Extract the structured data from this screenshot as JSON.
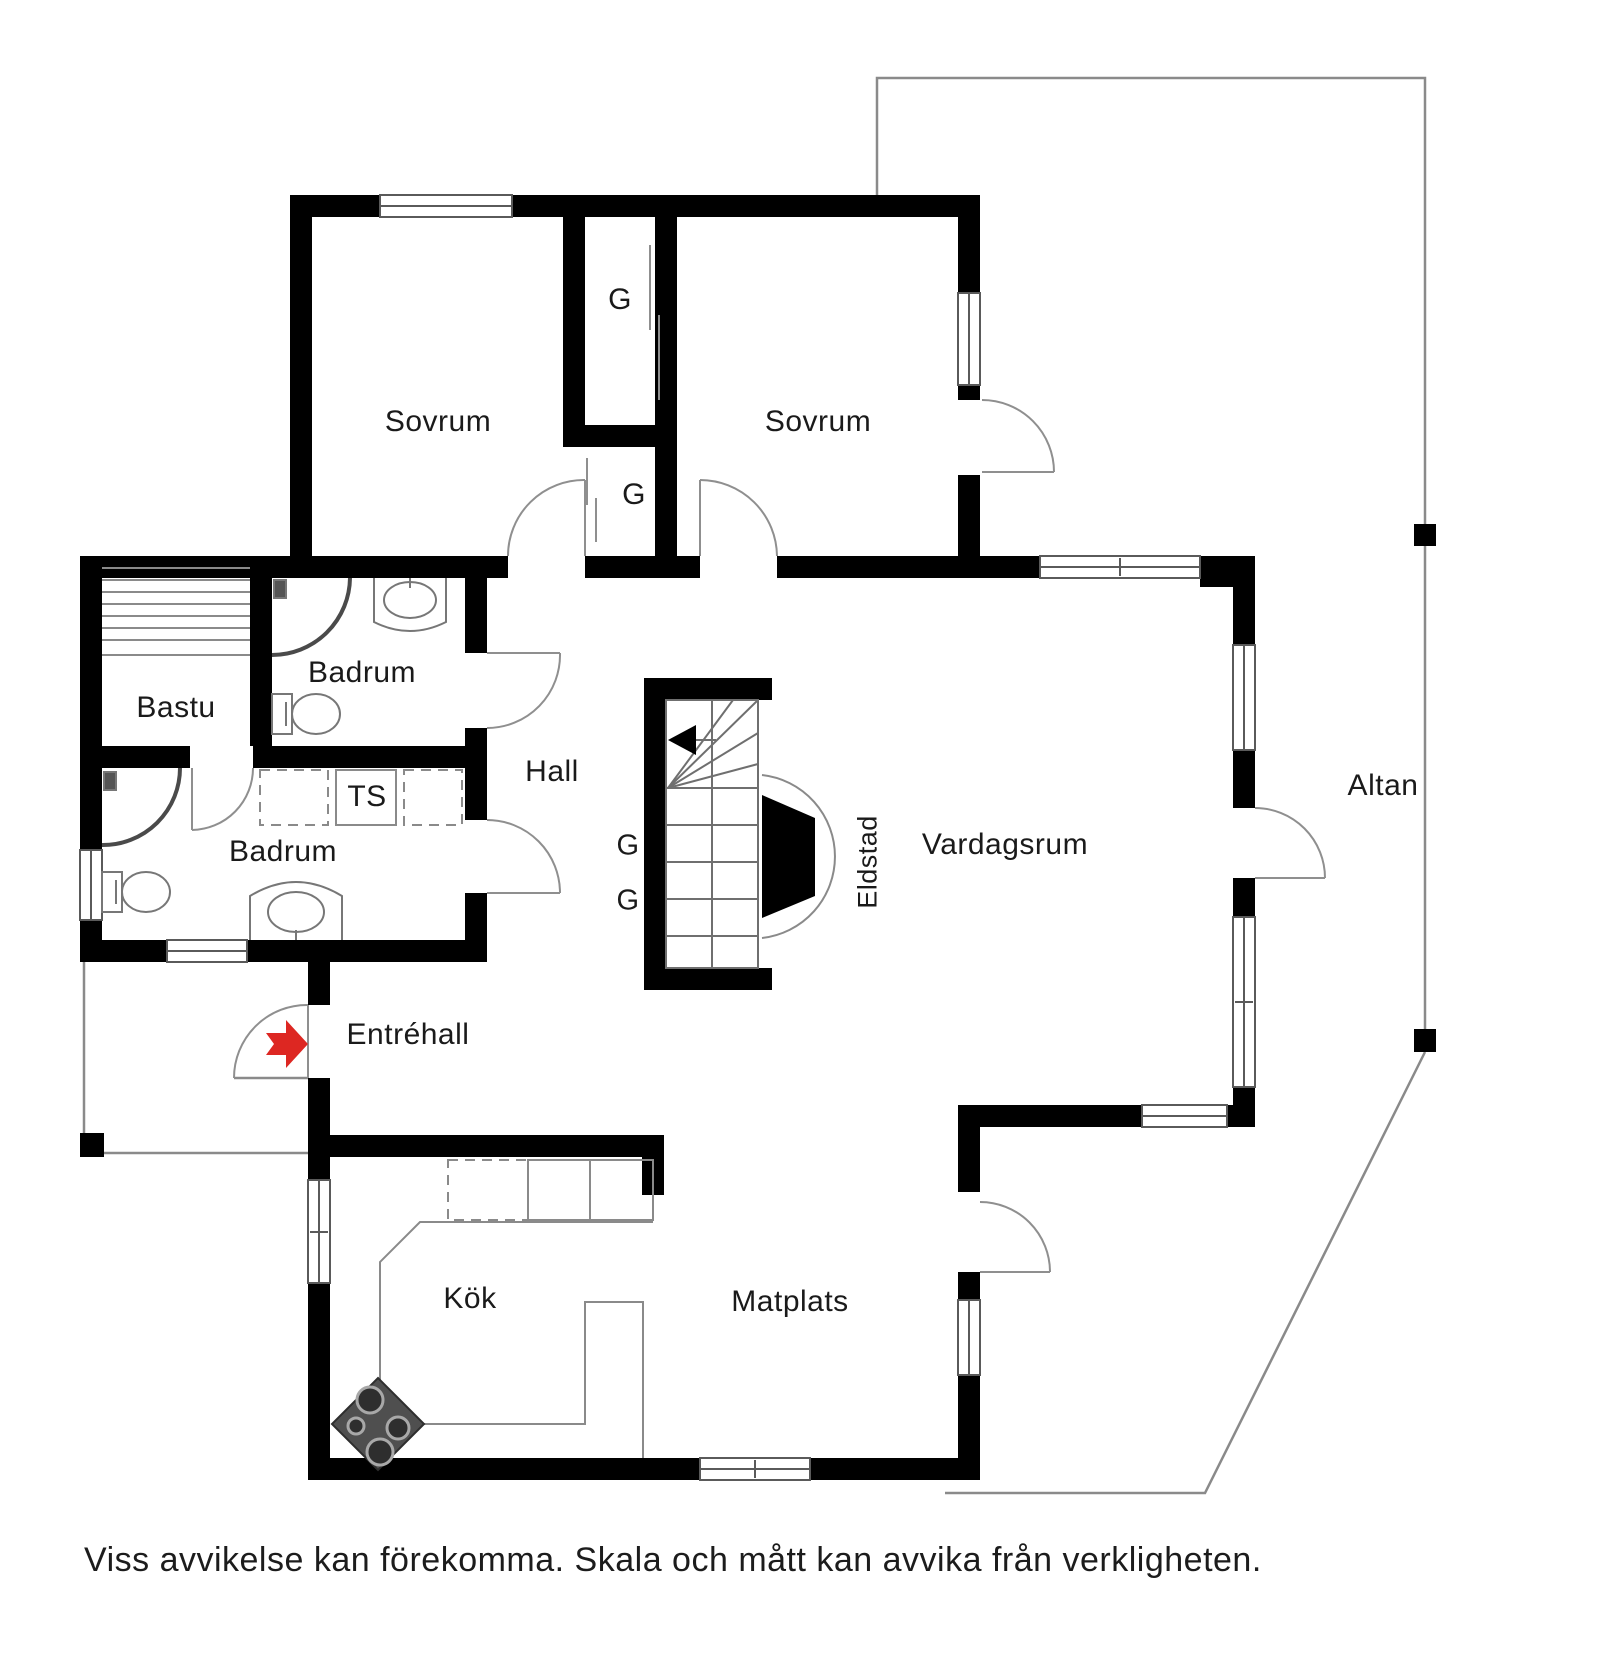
{
  "rooms": {
    "sovrum1": "Sovrum",
    "sovrum2": "Sovrum",
    "closet_top": "G",
    "closet_mid": "G",
    "closet_stair_1": "G",
    "closet_stair_2": "G",
    "bastu": "Bastu",
    "badrum_upper": "Badrum",
    "badrum_lower": "Badrum",
    "ts": "TS",
    "hall": "Hall",
    "entrehall": "Entréhall",
    "kok": "Kök",
    "matplats": "Matplats",
    "vardagsrum": "Vardagsrum",
    "eldstad": "Eldstad",
    "altan": "Altan"
  },
  "footer": {
    "disclaimer": "Viss avvikelse kan förekomma. Skala och mått kan avvika från verkligheten."
  },
  "colors": {
    "wall": "#000000",
    "thin_line": "#8a8a8a",
    "window_stroke": "#5a5a5a",
    "entry_arrow": "#dd2722",
    "stove_body": "#4f4f4f",
    "text": "#1a1a1a"
  }
}
